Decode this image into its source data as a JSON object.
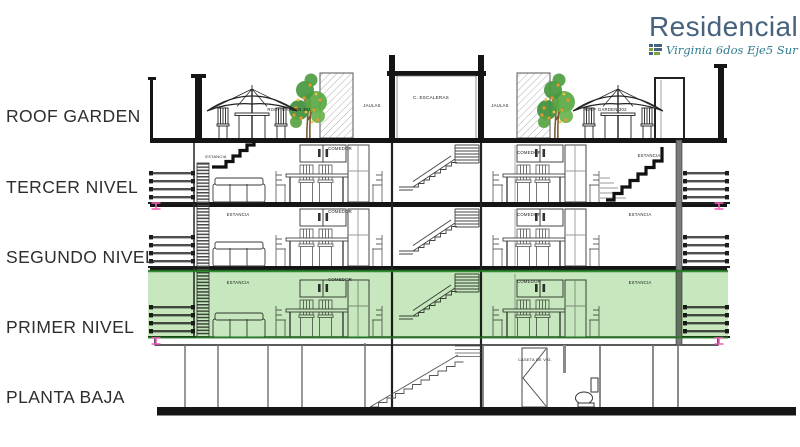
{
  "logo": {
    "title": "Residencial",
    "subtitle": "Virginia 6dos Eje5 Sur"
  },
  "levels": [
    {
      "label": "ROOF GARDEN"
    },
    {
      "label": "TERCER NIVEL"
    },
    {
      "label": "SEGUNDO NIVEL"
    },
    {
      "label": "PRIMER NIVEL"
    },
    {
      "label": "PLANTA BAJA"
    }
  ],
  "plan": {
    "labels": {
      "roof_garden_left": "ROOF GARDEN 301",
      "roof_garden_right": "ROOF GARDEN 302",
      "jaulas": "JAULAS",
      "stair_core": "C. ESCALERAS",
      "estancia": "ESTANCIA",
      "comedor": "COMEDOR",
      "caseta": "CASETA DE VIG."
    }
  },
  "colors": {
    "logo_blue": "#46627d",
    "logo_teal": "#2e7b8c",
    "logo_green": "#7aa43c",
    "highlight_green": "#82c96e",
    "highlight_edge": "#1e7a1e",
    "marker_pink": "#ef5fb7",
    "line_black": "#151515"
  }
}
